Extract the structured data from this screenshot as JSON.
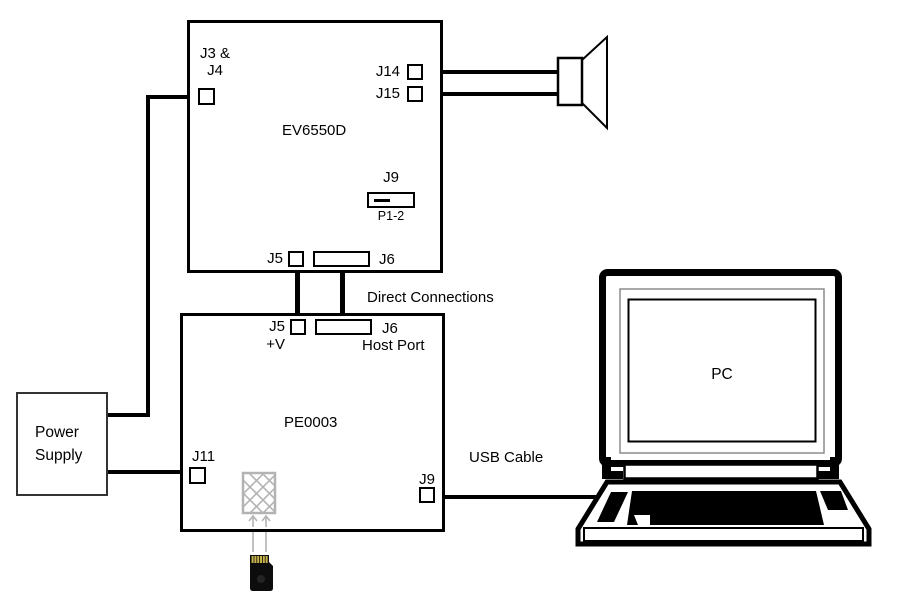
{
  "ev6550d": {
    "title": "EV6550D",
    "j3_line1": "J3 &",
    "j3_line2": "J4",
    "j14": "J14",
    "j15": "J15",
    "j9": "J9",
    "p1_2": "P1-2",
    "j5": "J5",
    "j6": "J6"
  },
  "pe0003": {
    "title": "PE0003",
    "j5": "J5",
    "plus_v": "+V",
    "j6": "J6",
    "host_port": "Host Port",
    "j11": "J11",
    "j9": "J9"
  },
  "power_supply": {
    "line1": "Power",
    "line2": "Supply"
  },
  "pc_label": "PC",
  "connection_labels": {
    "direct": "Direct Connections",
    "usb": "USB Cable"
  },
  "colors": {
    "line": "#000000",
    "hatch_gray": "#b3b3b3",
    "sd_body": "#0d0d0d",
    "sd_gold": "#c9b44b"
  }
}
